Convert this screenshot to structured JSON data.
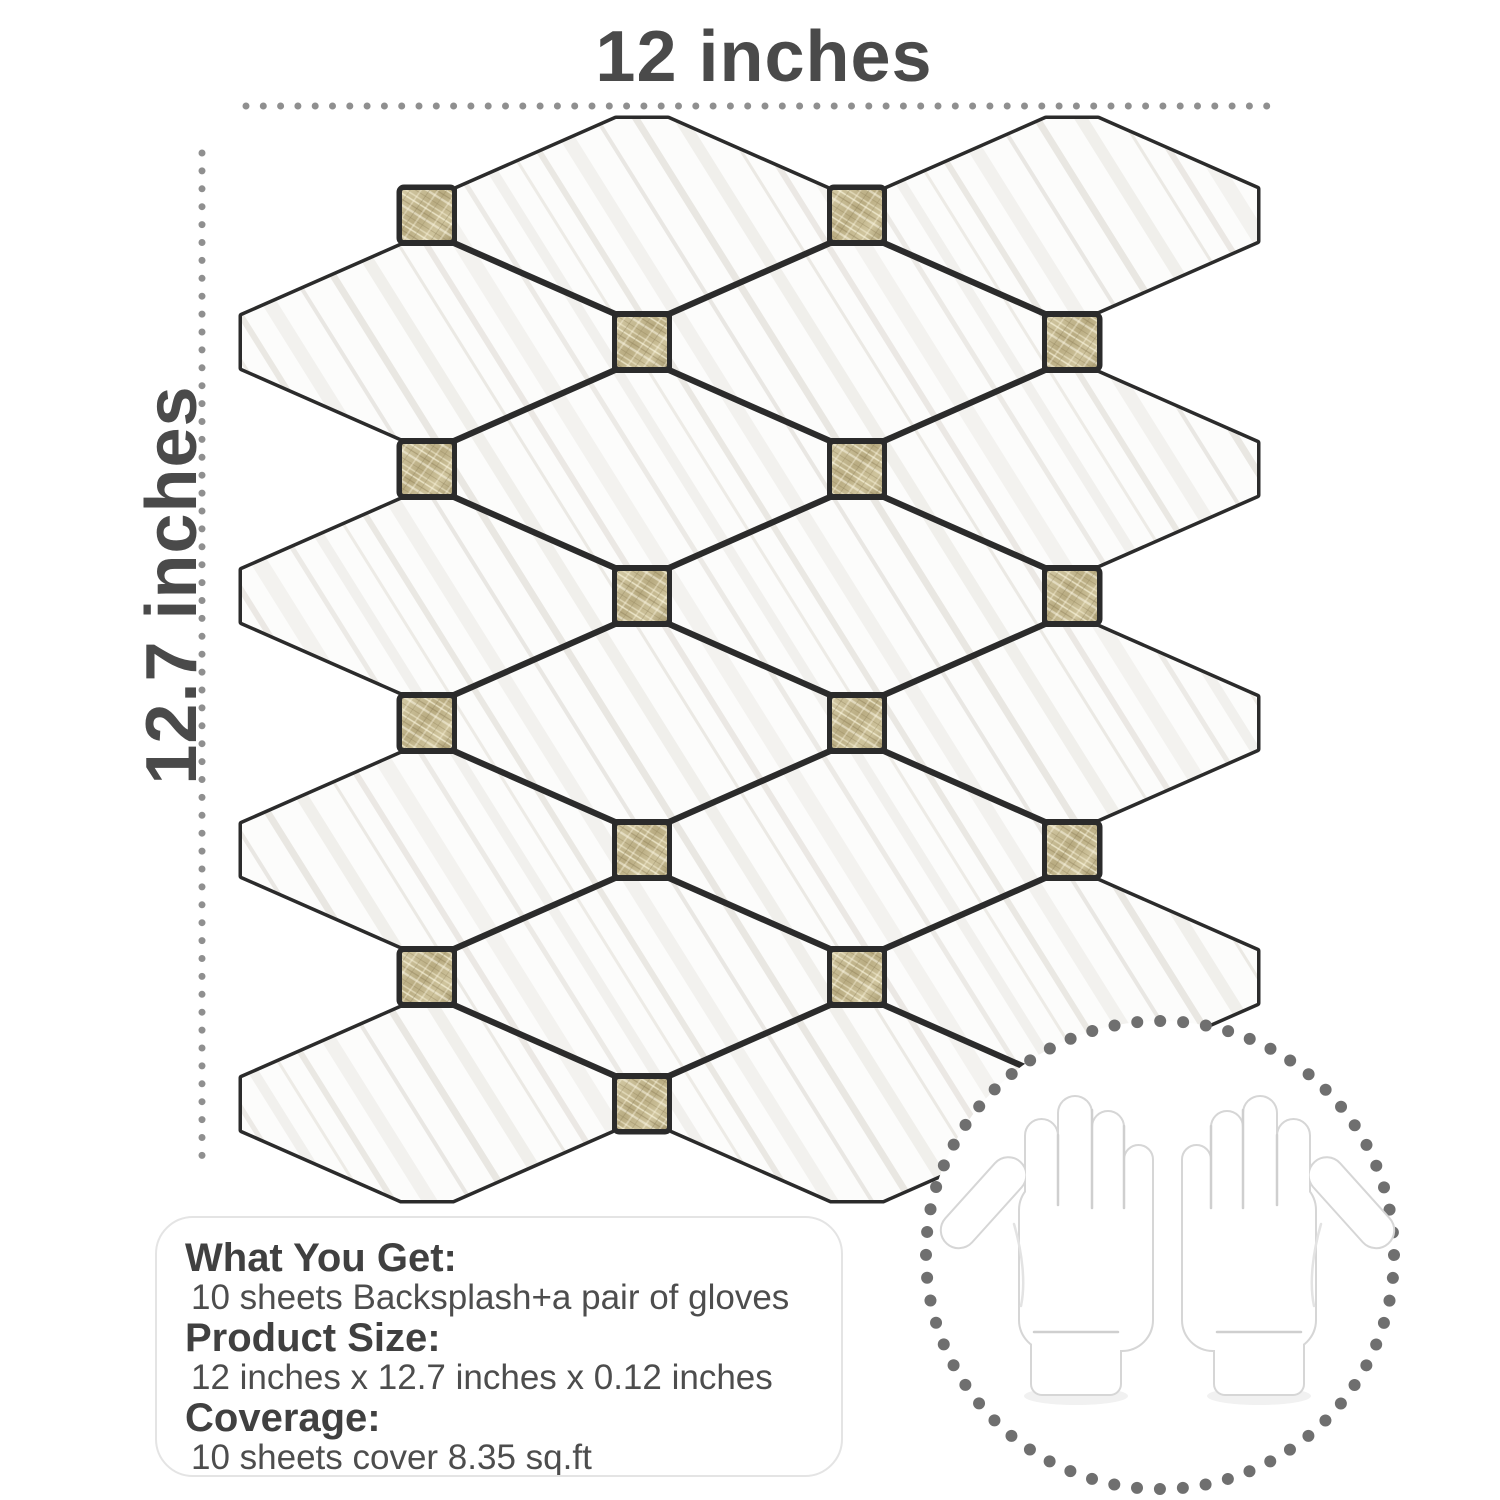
{
  "annotations": {
    "top_width_label": "12 inches",
    "left_height_label": "12.7 inches"
  },
  "info_box": {
    "what_you_get_label": "What You Get:",
    "what_you_get_value": "10 sheets Backsplash+a pair of gloves",
    "product_size_label": "Product Size:",
    "product_size_value": "12 inches x 12.7 inches x 0.12 inches",
    "coverage_label": "Coverage:",
    "coverage_value": "10 sheets cover 8.35 sq.ft"
  },
  "colors": {
    "label_text": "#4a4a4a",
    "dimension_dots": "#8f8f8f",
    "grout": "#2b2b2b",
    "tile_white": "#fcfcfb",
    "gold_base": "#bfb28a",
    "circle_dots": "#6f6f6f",
    "box_border": "#e4e4e4",
    "glove_outline": "#d6d6d6"
  }
}
